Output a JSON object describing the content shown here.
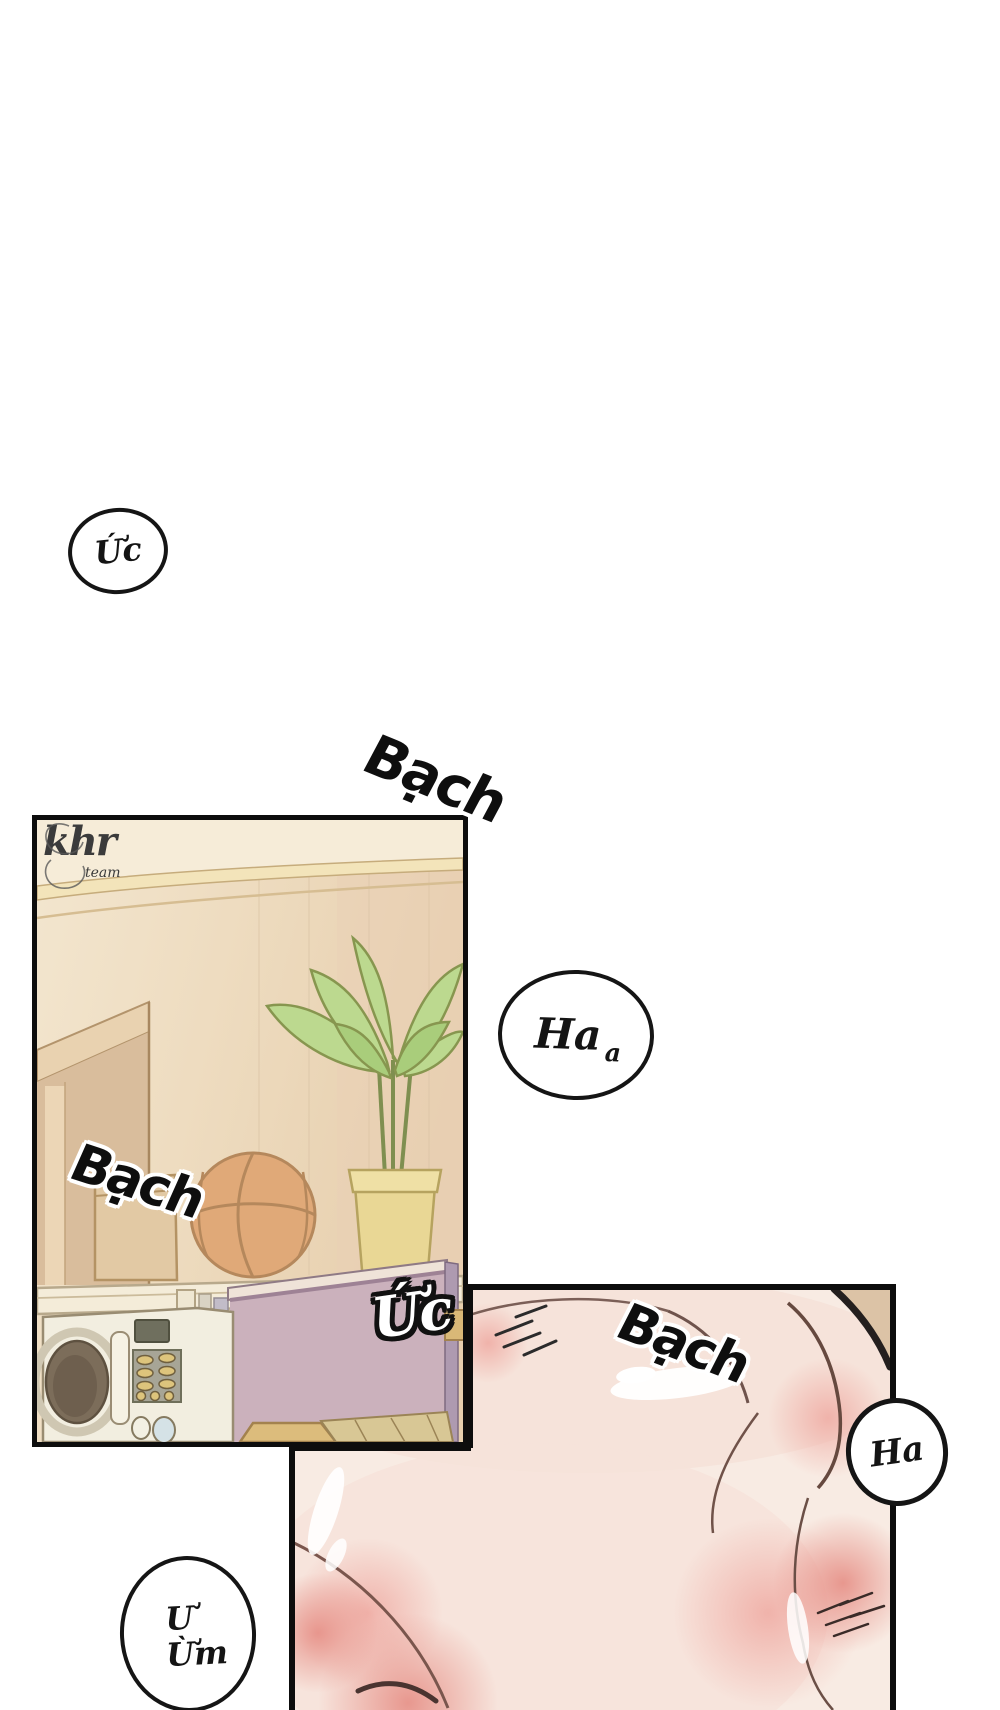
{
  "page": {
    "width": 1000,
    "height": 1710,
    "background": "#ffffff"
  },
  "watermark": {
    "main": "khr",
    "sub": "team"
  },
  "sfx": {
    "bach_top": "Bạch",
    "bach_room": "Bạch",
    "uc_room": "Ức",
    "bach_skin": "Bạch"
  },
  "bubbles": {
    "uc": {
      "text": "Ức"
    },
    "ha_a": {
      "main": "Ha",
      "sub": "a"
    },
    "ha": {
      "text": "Ha"
    },
    "u_um": {
      "line1": "Ư",
      "line2": "Ừm"
    }
  },
  "colors": {
    "panel_border": "#0d0d0d",
    "wall": "#efddc1",
    "wall_shadow": "#e2c7a6",
    "molding": "#f3e4ba",
    "basketball": "#e0a978",
    "leaf": "#bcd98f",
    "pot": "#e9d795",
    "shelf": "#f4ecd9",
    "microwave": "#f2eee0",
    "board": "#cbb1bc",
    "skin": "#f8ebe3",
    "blush": "#efaaa2"
  }
}
